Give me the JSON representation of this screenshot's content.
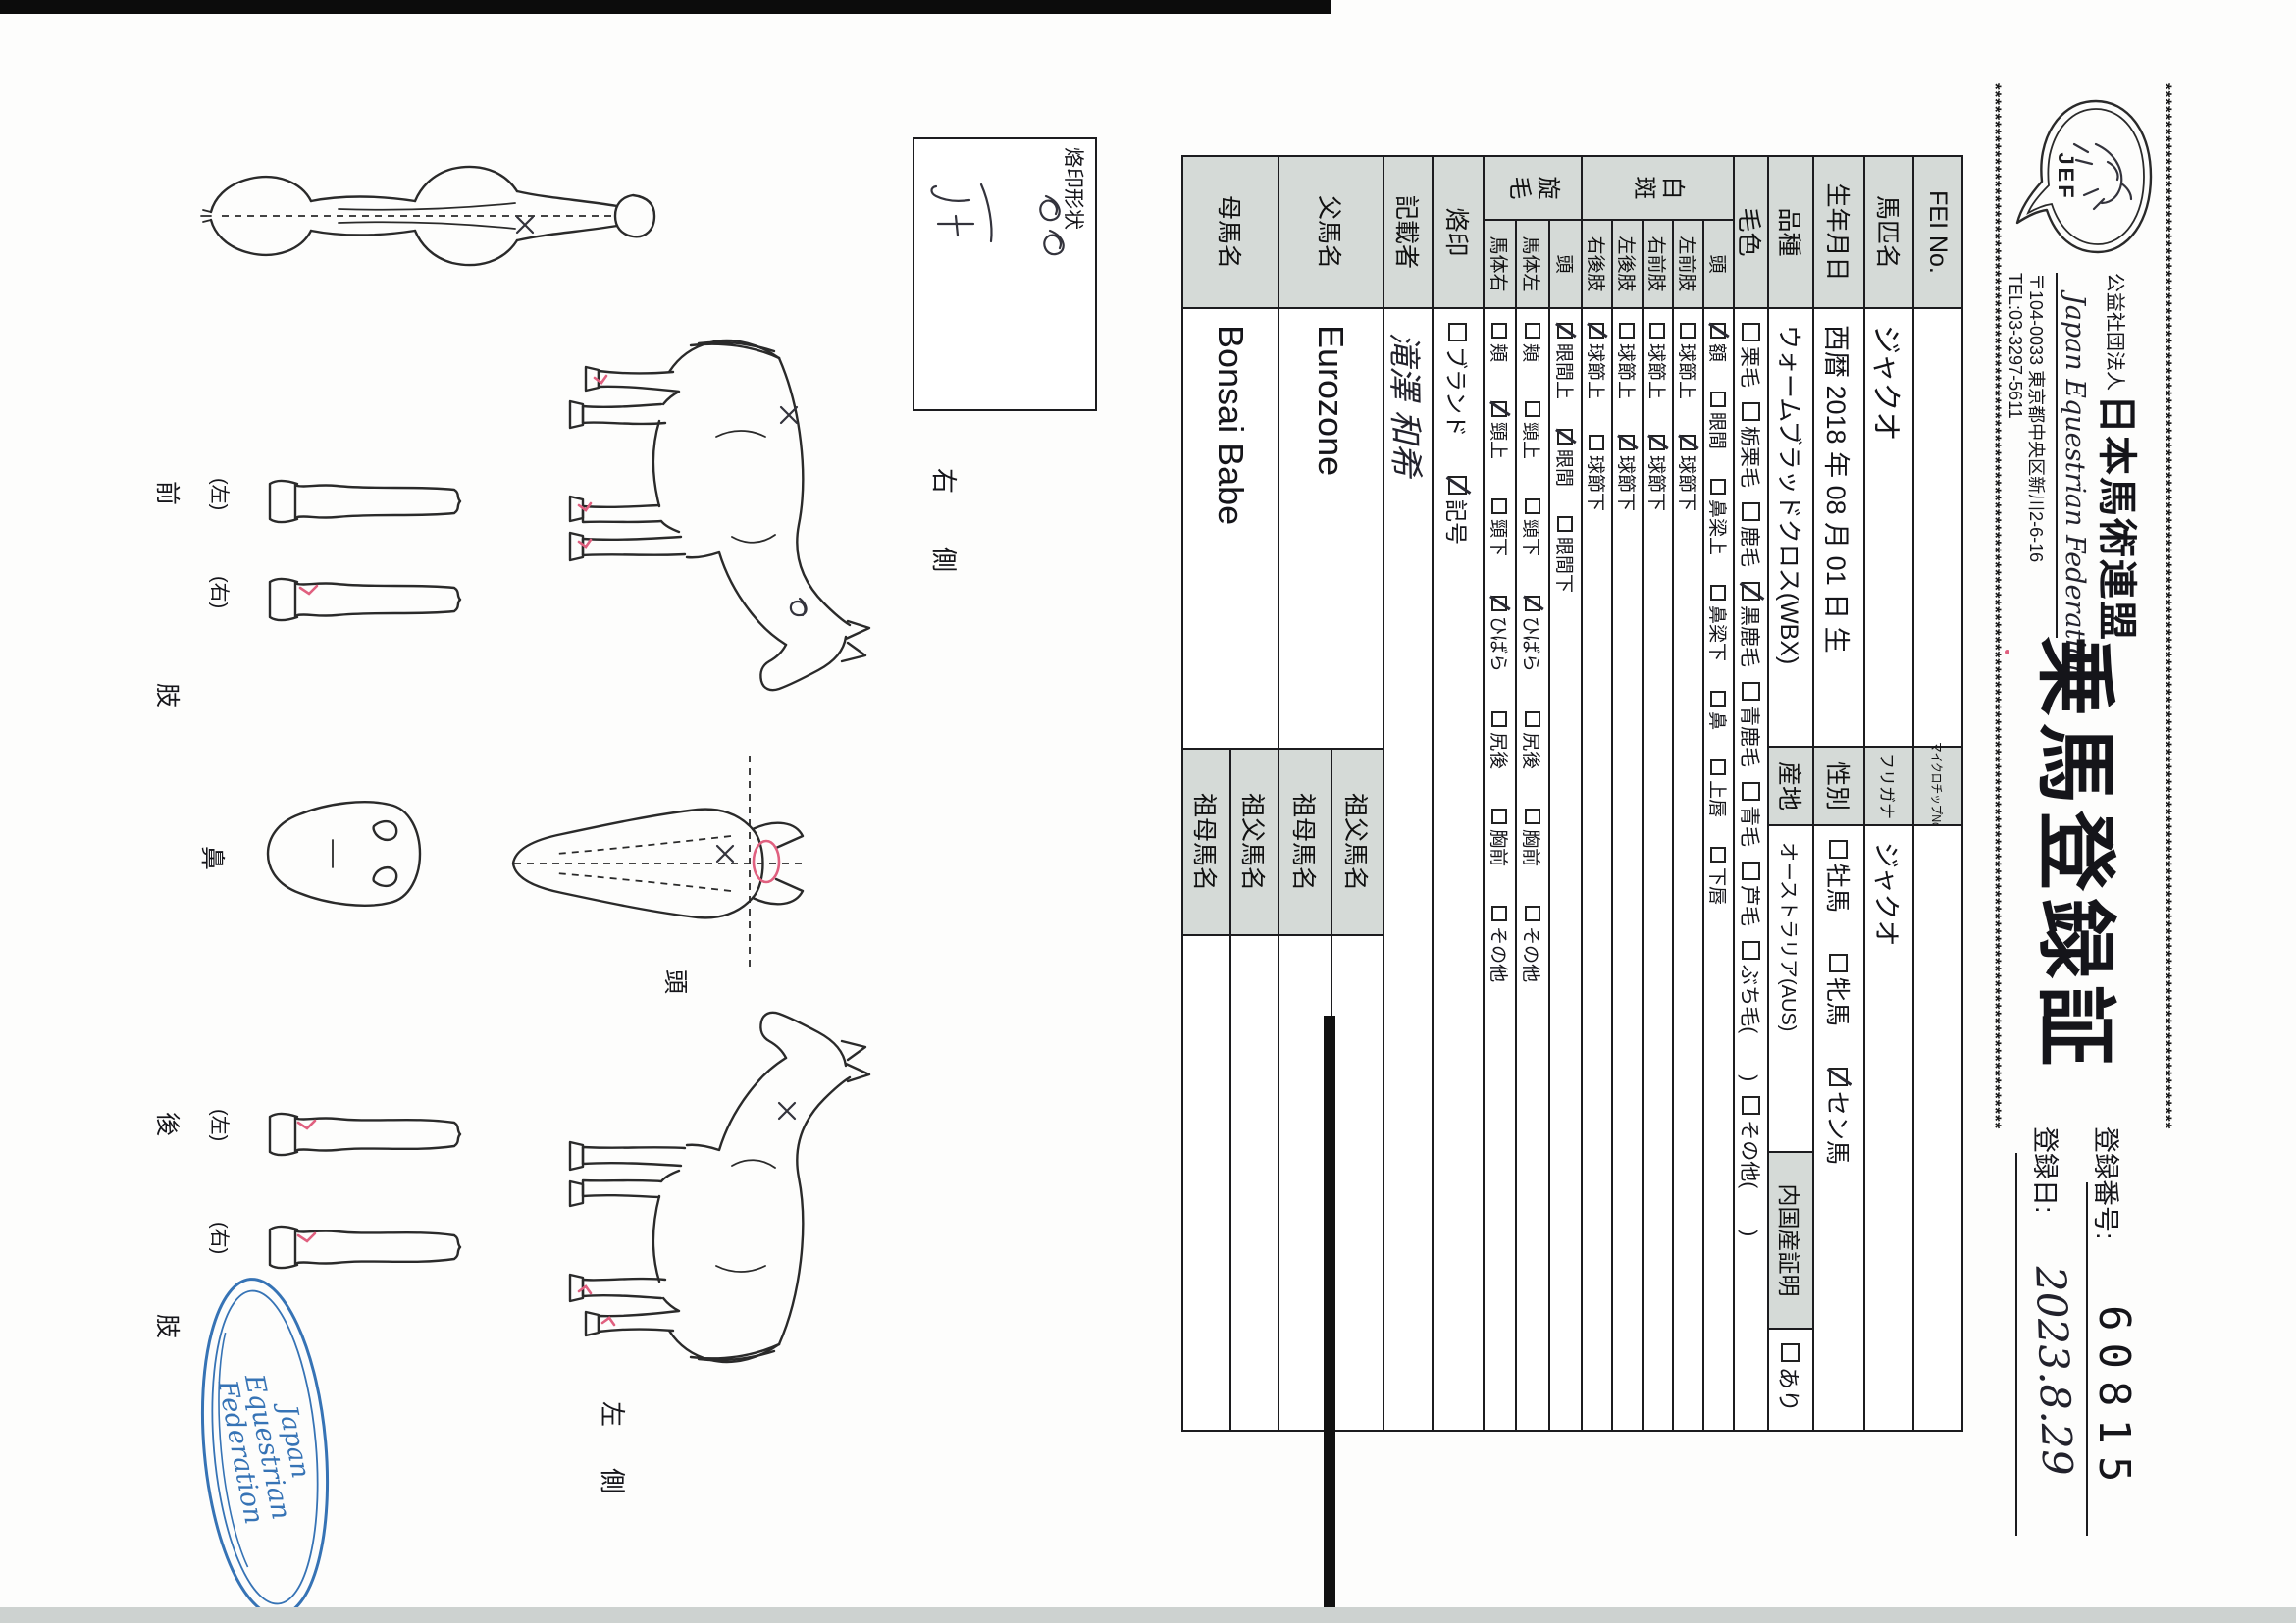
{
  "page": {
    "org_small": "公益社団法人",
    "org_name": "日本馬術連盟",
    "org_en": "Japan Equestrian Federation",
    "org_address": "〒104-0033 東京都中央区新川2-6-16",
    "org_tel": "TEL:03-3297-5611",
    "logo_text": "JEF",
    "title": "乗馬登録証",
    "reg_no_label": "登録番号:",
    "reg_no": "60815",
    "reg_date_label": "登録日:",
    "reg_date": "2023.8.29",
    "border_char": "*"
  },
  "table": {
    "fei_label": "FEI No.",
    "fei_value": "",
    "microchip_label": "マイクロチップNo.",
    "microchip_value": "",
    "name_label": "馬匹名",
    "name_value": "ジャクオ",
    "furigana_label": "フリガナ",
    "furigana_value": "ジャクオ",
    "birth_label": "生年月日",
    "birth_value": "西暦 2018 年 08 月 01 日 生",
    "sex_label": "性別",
    "sex_options": [
      {
        "label": "牡馬",
        "checked": false
      },
      {
        "label": "牝馬",
        "checked": false
      },
      {
        "label": "セン馬",
        "checked": true
      }
    ],
    "breed_label": "品種",
    "breed_value": "ウォームブラッドクロス(WBX)",
    "origin_label": "産地",
    "origin_value": "オーストラリア(AUS)",
    "domestic_label": "内国産証明",
    "domestic_options": [
      {
        "label": "あり",
        "checked": false
      }
    ],
    "coat_label": "毛色",
    "coat_options": [
      {
        "label": "栗毛",
        "checked": false
      },
      {
        "label": "栃栗毛",
        "checked": false
      },
      {
        "label": "鹿毛",
        "checked": false
      },
      {
        "label": "黒鹿毛",
        "checked": true
      },
      {
        "label": "青鹿毛",
        "checked": false
      },
      {
        "label": "青毛",
        "checked": false
      },
      {
        "label": "芦毛",
        "checked": false
      },
      {
        "label": "ぶち毛(　　)",
        "checked": false
      },
      {
        "label": "その他(　　)",
        "checked": false
      }
    ],
    "hakuhan_label": "白斑",
    "hakuhan_rows": [
      {
        "label": "頭",
        "options": [
          {
            "label": "額",
            "checked": true
          },
          {
            "label": "眼間",
            "checked": false
          },
          {
            "label": "鼻梁上",
            "checked": false
          },
          {
            "label": "鼻梁下",
            "checked": false
          },
          {
            "label": "鼻",
            "checked": false
          },
          {
            "label": "上唇",
            "checked": false
          },
          {
            "label": "下唇",
            "checked": false
          }
        ]
      },
      {
        "label": "左前肢",
        "options": [
          {
            "label": "球節上",
            "checked": false
          },
          {
            "label": "球節下",
            "checked": true
          }
        ]
      },
      {
        "label": "右前肢",
        "options": [
          {
            "label": "球節上",
            "checked": false
          },
          {
            "label": "球節下",
            "checked": true
          }
        ]
      },
      {
        "label": "左後肢",
        "options": [
          {
            "label": "球節上",
            "checked": false
          },
          {
            "label": "球節下",
            "checked": true
          }
        ]
      },
      {
        "label": "右後肢",
        "options": [
          {
            "label": "球節上",
            "checked": true
          },
          {
            "label": "球節下",
            "checked": false
          }
        ]
      }
    ],
    "senmou_label": "旋毛",
    "senmou_rows": [
      {
        "label": "頭",
        "options": [
          {
            "label": "眼間上",
            "checked": true
          },
          {
            "label": "眼間",
            "checked": true
          },
          {
            "label": "眼間下",
            "checked": false
          }
        ]
      },
      {
        "label": "馬体左",
        "options": [
          {
            "label": "頬",
            "checked": false
          },
          {
            "label": "頸上",
            "checked": false
          },
          {
            "label": "頸下",
            "checked": false
          },
          {
            "label": "ひばら",
            "checked": true
          },
          {
            "label": "尻後",
            "checked": false
          },
          {
            "label": "胸前",
            "checked": false
          },
          {
            "label": "その他",
            "checked": false
          }
        ]
      },
      {
        "label": "馬体右",
        "options": [
          {
            "label": "頬",
            "checked": false
          },
          {
            "label": "頸上",
            "checked": true
          },
          {
            "label": "頸下",
            "checked": false
          },
          {
            "label": "ひばら",
            "checked": true
          },
          {
            "label": "尻後",
            "checked": false
          },
          {
            "label": "胸前",
            "checked": false
          },
          {
            "label": "その他",
            "checked": false
          }
        ]
      }
    ],
    "rakuin_label": "烙印",
    "rakuin_options": [
      {
        "label": "ブランド",
        "checked": false
      },
      {
        "label": "記号",
        "checked": true
      }
    ],
    "recorder_label": "記載者",
    "recorder_value": "滝澤 和希",
    "sire_label": "父馬名",
    "sire_value": "Eurozone",
    "dam_label": "母馬名",
    "dam_value": "Bonsai Babe",
    "grandsire_label": "祖父馬名",
    "granddam_label": "祖母馬名",
    "sire_grandsire_value": "",
    "sire_granddam_value": "",
    "dam_grandsire_value": "",
    "dam_granddam_value": ""
  },
  "diagram": {
    "brand_box_label": "烙印形状",
    "right_side_label": "右　側",
    "left_side_label": "左　側",
    "head_label": "頭",
    "nose_label": "鼻",
    "front_leg_label": "前　肢",
    "hind_leg_label": "後　肢",
    "left_paren": "(左)",
    "right_paren": "(右)",
    "stamp_line1": "Japan",
    "stamp_line2": "Equestrian",
    "stamp_line3": "Federation"
  },
  "colors": {
    "header_gray": "#d5dad7",
    "stamp_blue": "#3673b5",
    "mark_pink": "#e0607f",
    "border_black": "#1c1c1f"
  }
}
